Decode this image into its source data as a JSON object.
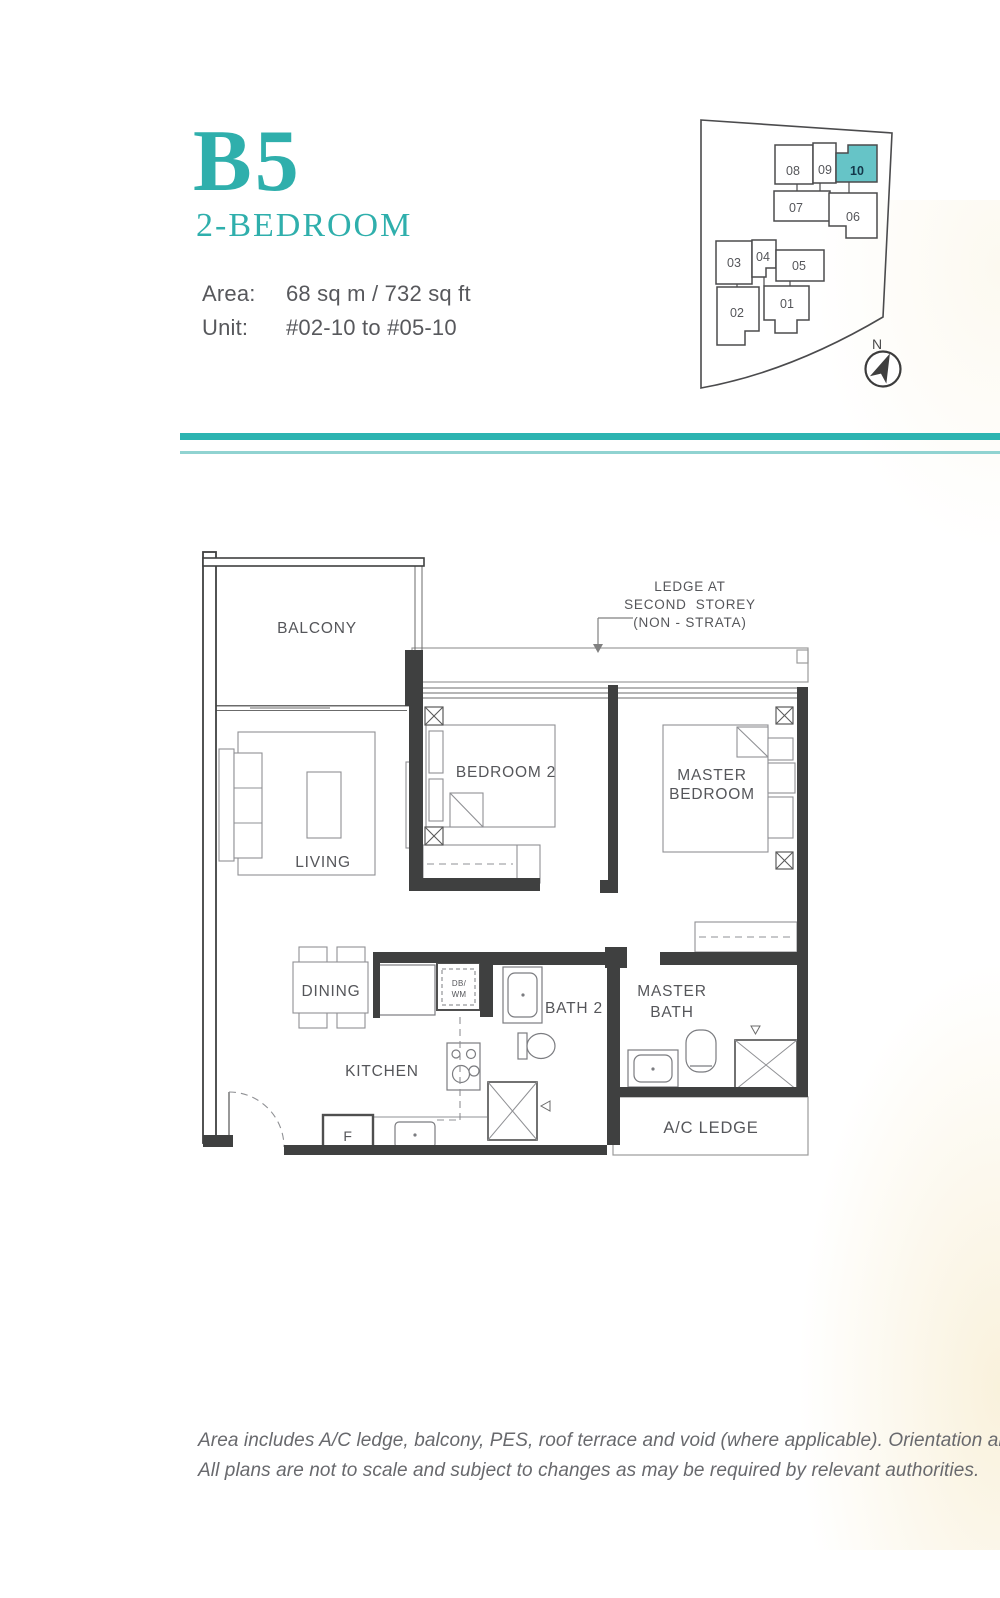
{
  "page": {
    "width": 1000,
    "height": 1598
  },
  "colors": {
    "accent": "#2FAFAC",
    "separator_dark": "#2CB4B1",
    "separator_light": "#90D3D1",
    "keyplan_highlight": "#66C4C7",
    "text_gray": "#55565A"
  },
  "header": {
    "plan_code": "B5",
    "plan_type": "2-BEDROOM",
    "area_label": "Area:",
    "area_value": "68 sq m / 732 sq ft",
    "unit_label": "Unit:",
    "unit_value": "#02-10 to #05-10"
  },
  "key_plan": {
    "north_label": "N",
    "highlighted_unit": "10",
    "units": [
      {
        "label": "08"
      },
      {
        "label": "09"
      },
      {
        "label": "10"
      },
      {
        "label": "07"
      },
      {
        "label": "06"
      },
      {
        "label": "03"
      },
      {
        "label": "04"
      },
      {
        "label": "05"
      },
      {
        "label": "02"
      },
      {
        "label": "01"
      }
    ]
  },
  "floor_plan": {
    "labels": {
      "balcony": "BALCONY",
      "living": "LIVING",
      "bedroom2": "BEDROOM 2",
      "master_bedroom_l1": "MASTER",
      "master_bedroom_l2": "BEDROOM",
      "dining": "DINING",
      "kitchen": "KITCHEN",
      "bath2": "BATH 2",
      "master_bath_l1": "MASTER",
      "master_bath_l2": "BATH",
      "ac_ledge": "A/C LEDGE",
      "fridge": "F",
      "db_l1": "DB/",
      "db_l2": "WM"
    },
    "annotation": {
      "l1": "LEDGE AT",
      "l2": "SECOND  STOREY",
      "l3": "(NON - STRATA)"
    }
  },
  "footer": {
    "line1": "Area includes A/C ledge, balcony, PES, roof terrace and void (where applicable). Orientation an",
    "line2": "All plans are not to scale and subject to changes as may be required by relevant authorities."
  }
}
